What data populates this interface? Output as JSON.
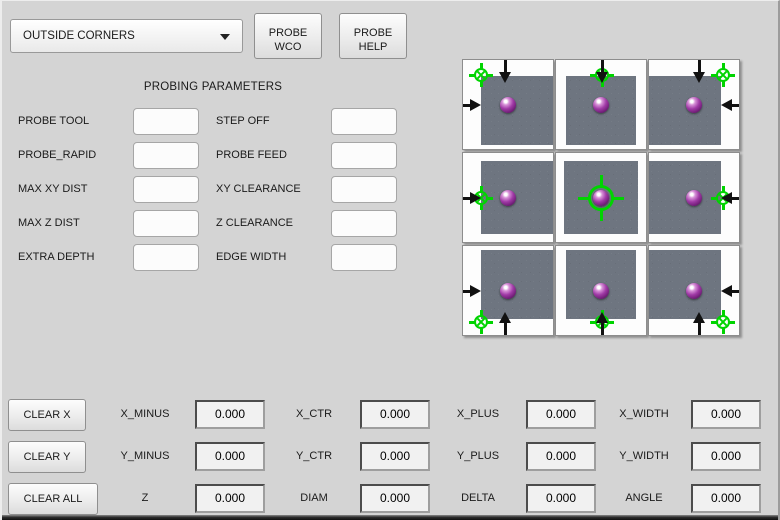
{
  "header": {
    "mode_dropdown": {
      "value": "OUTSIDE CORNERS"
    },
    "probe_wco_button": {
      "line1": "PROBE",
      "line2": "WCO"
    },
    "probe_help_button": {
      "line1": "PROBE",
      "line2": "HELP"
    }
  },
  "parameters": {
    "title": "PROBING PARAMETERS",
    "fields": [
      {
        "label": "PROBE TOOL",
        "value": ""
      },
      {
        "label": "STEP OFF",
        "value": ""
      },
      {
        "label": "PROBE_RAPID",
        "value": ""
      },
      {
        "label": "PROBE FEED",
        "value": ""
      },
      {
        "label": "MAX XY DIST",
        "value": ""
      },
      {
        "label": "XY CLEARANCE",
        "value": ""
      },
      {
        "label": "MAX Z DIST",
        "value": ""
      },
      {
        "label": "Z CLEARANCE",
        "value": ""
      },
      {
        "label": "EXTRA DEPTH",
        "value": ""
      },
      {
        "label": "EDGE WIDTH",
        "value": ""
      }
    ]
  },
  "probe_grid": {
    "tiles": [
      "top-left-corner",
      "top-edge",
      "top-right-corner",
      "left-edge",
      "center",
      "right-edge",
      "bottom-left-corner",
      "bottom-edge",
      "bottom-right-corner"
    ],
    "colors": {
      "target_green": "#00d400",
      "workpiece_gray": "#6e7580",
      "ball_purple": "#a03aa6"
    }
  },
  "results": {
    "clear_x_button": "CLEAR X",
    "clear_y_button": "CLEAR Y",
    "clear_all_button": "CLEAR ALL",
    "rows": [
      {
        "cells": [
          {
            "label": "X_MINUS",
            "value": "0.000"
          },
          {
            "label": "X_CTR",
            "value": "0.000"
          },
          {
            "label": "X_PLUS",
            "value": "0.000"
          },
          {
            "label": "X_WIDTH",
            "value": "0.000"
          }
        ]
      },
      {
        "cells": [
          {
            "label": "Y_MINUS",
            "value": "0.000"
          },
          {
            "label": "Y_CTR",
            "value": "0.000"
          },
          {
            "label": "Y_PLUS",
            "value": "0.000"
          },
          {
            "label": "Y_WIDTH",
            "value": "0.000"
          }
        ]
      },
      {
        "cells": [
          {
            "label": "Z",
            "value": "0.000"
          },
          {
            "label": "DIAM",
            "value": "0.000"
          },
          {
            "label": "DELTA",
            "value": "0.000"
          },
          {
            "label": "ANGLE",
            "value": "0.000"
          }
        ]
      }
    ]
  }
}
